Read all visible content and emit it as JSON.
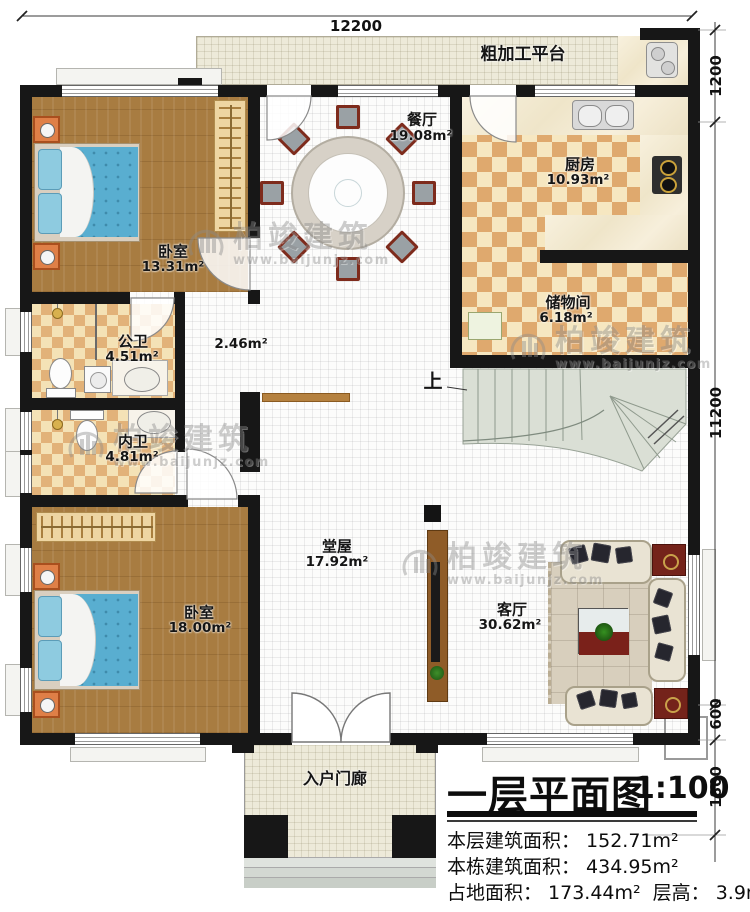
{
  "plan_title": {
    "text": "一层平面图",
    "scale": "1:100"
  },
  "stats": {
    "floor_area_label": "本层建筑面积：",
    "floor_area_value": "152.71m²",
    "building_area_label": "本栋建筑面积：",
    "building_area_value": "434.95m²",
    "footprint_label": "占地面积：",
    "footprint_value": "173.44m²",
    "height_label": "层高：",
    "height_value": "3.9m"
  },
  "dimensions": {
    "top_width": "12200",
    "right_platform": "1200",
    "right_main": "11200",
    "right_offset": "600",
    "right_porch": "1800"
  },
  "rooms": [
    {
      "name": "粗加工平台",
      "area": ""
    },
    {
      "name": "餐厅",
      "area": "19.08m²"
    },
    {
      "name": "厨房",
      "area": "10.93m²"
    },
    {
      "name": "储物间",
      "area": "6.18m²"
    },
    {
      "name": "卧室",
      "area": "13.31m²"
    },
    {
      "name": "公卫",
      "area": "4.51m²"
    },
    {
      "name": "",
      "area": "2.46m²"
    },
    {
      "name": "内卫",
      "area": "4.81m²"
    },
    {
      "name": "卧室",
      "area": "18.00m²"
    },
    {
      "name": "堂屋",
      "area": "17.92m²"
    },
    {
      "name": "客厅",
      "area": "30.62m²"
    },
    {
      "name": "入户门廊",
      "area": ""
    }
  ],
  "stairs": {
    "up_label": "上"
  },
  "watermark": {
    "brand": "柏竣建筑",
    "url": "www.baijunjz.com"
  }
}
